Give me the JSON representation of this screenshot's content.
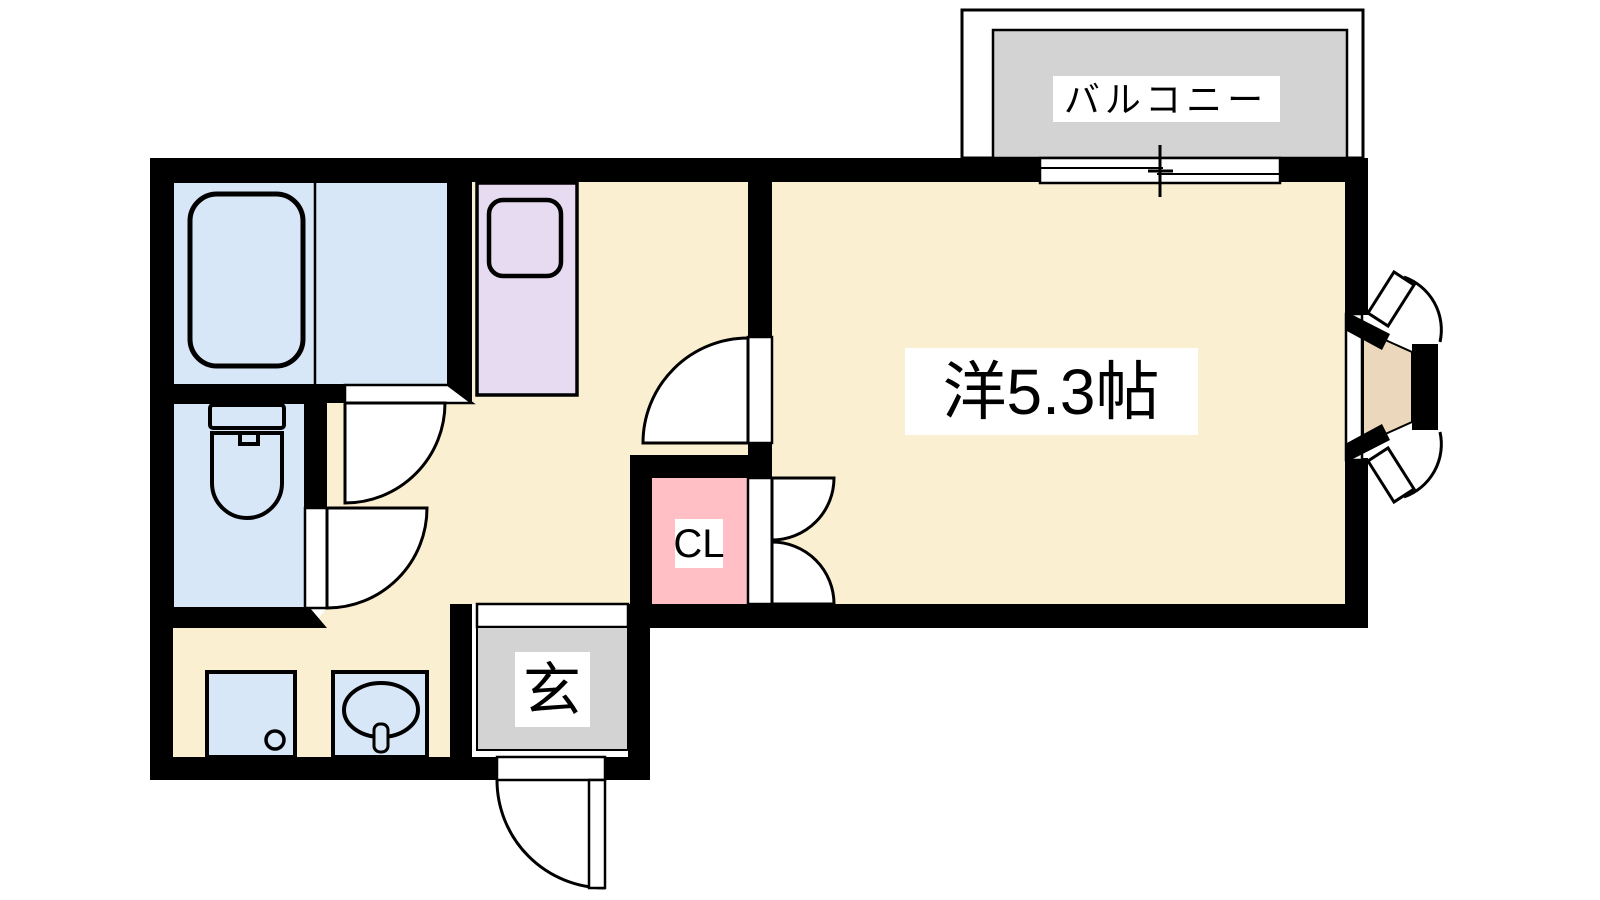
{
  "floorplan": {
    "type": "apartment-floor-plan",
    "labels": {
      "balcony": "バルコニー",
      "main_room": "洋5.3帖",
      "closet": "CL",
      "entrance": "玄"
    },
    "colors": {
      "wall": "#000000",
      "floor": "#FBEFD2",
      "wet_area": "#D8E7F8",
      "kitchen_unit": "#E7DBF1",
      "closet": "#FFBFC5",
      "gray_area": "#D3D3D3",
      "bay_window": "#EBD8BC",
      "background": "#FFFFFF",
      "label_bg": "#FFFFFF",
      "text": "#000000"
    }
  }
}
